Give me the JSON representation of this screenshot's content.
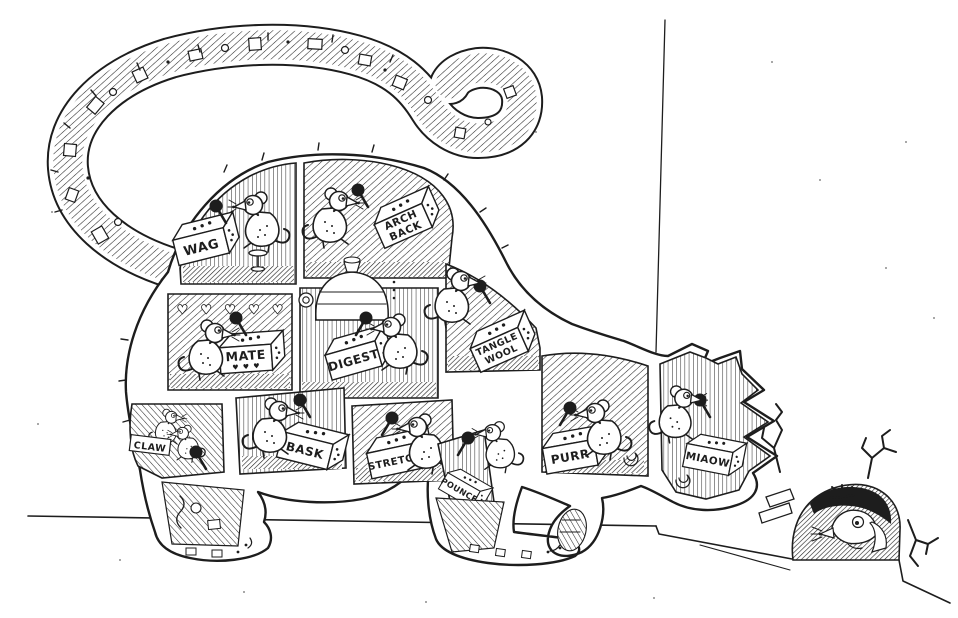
{
  "scene": {
    "type": "cartoon-illustration",
    "alt": "Cutaway cartoon of a crouching cat whose body is divided into control rooms, each run by a mouse pulling a lever; another mouse peeks from a hole in the wall.",
    "ink_color": "#1d1d1d",
    "background_color": "#ffffff",
    "rooms": [
      {
        "id": "wag",
        "label": "WAG"
      },
      {
        "id": "arch-back",
        "label": "ARCH BACK",
        "line1": "ARCH",
        "line2": "BACK"
      },
      {
        "id": "mate",
        "label": "MATE"
      },
      {
        "id": "digest",
        "label": "DIGEST"
      },
      {
        "id": "tangle-wool",
        "label": "TANGLE WOOL",
        "line1": "TANGLE",
        "line2": "WOOL"
      },
      {
        "id": "claw",
        "label": "CLAW"
      },
      {
        "id": "bask",
        "label": "BASK"
      },
      {
        "id": "stretch",
        "label": "STRETCH"
      },
      {
        "id": "pounce",
        "label": "POUNCE"
      },
      {
        "id": "purr",
        "label": "PURR"
      },
      {
        "id": "miaow",
        "label": "MIAOW"
      }
    ],
    "icons": {
      "hearts_row": "♥ ♥ ♥ ♥ ♥",
      "hearts_small": "♥ ♥ ♥"
    }
  }
}
